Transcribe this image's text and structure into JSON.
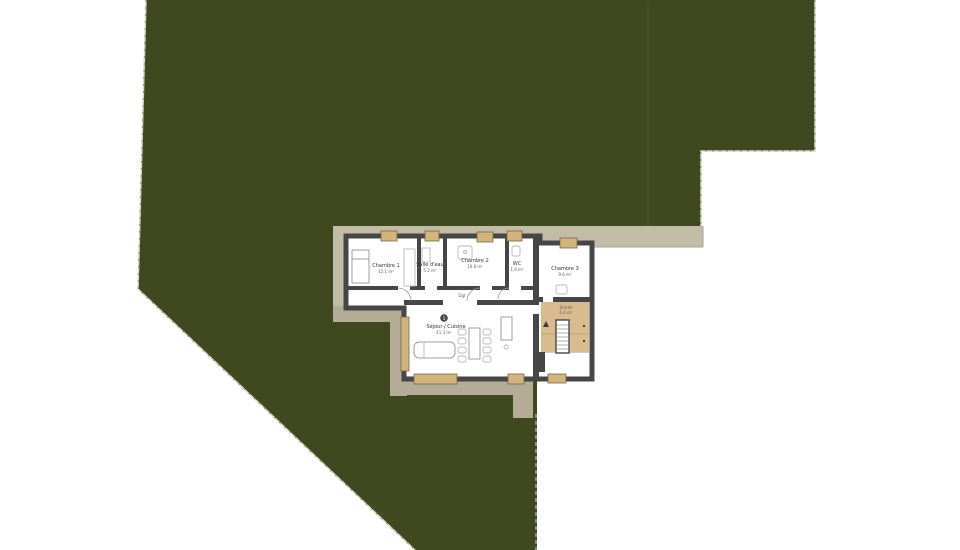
{
  "colors": {
    "lawn": "#3f481e",
    "lawn_line": "#4b5424",
    "lawn_edge": "#dcd9c9",
    "path": "#c2bca6",
    "path_dark": "#b4ac96",
    "wall": "#464646",
    "floor": "#ffffff",
    "entry_floor": "#d8bc90",
    "window": "#d3b47f",
    "window_edge": "#7a6742",
    "furniture": "#9f9f9f",
    "fence": "#8f8f85",
    "label": "#333333"
  },
  "rooms": [
    {
      "id": "chambre-1",
      "label": "Chambre 1",
      "area": "12.1 m²"
    },
    {
      "id": "salle-eau",
      "label": "Salle d'eau",
      "area": "5.2 m²"
    },
    {
      "id": "chambre-2",
      "label": "Chambre 2",
      "area": "10.8 m²"
    },
    {
      "id": "wc",
      "label": "WC",
      "area": "1.9 m²"
    },
    {
      "id": "chambre-3",
      "label": "Chambre 3",
      "area": "9.6 m²"
    },
    {
      "id": "degagement",
      "label": "Dgt"
    },
    {
      "id": "sejour-cuisine",
      "label": "Séjour / Cuisine",
      "area": "41.3 m²",
      "number": "1"
    },
    {
      "id": "entree",
      "label": "Entrée",
      "area": "6.4 m²"
    }
  ]
}
